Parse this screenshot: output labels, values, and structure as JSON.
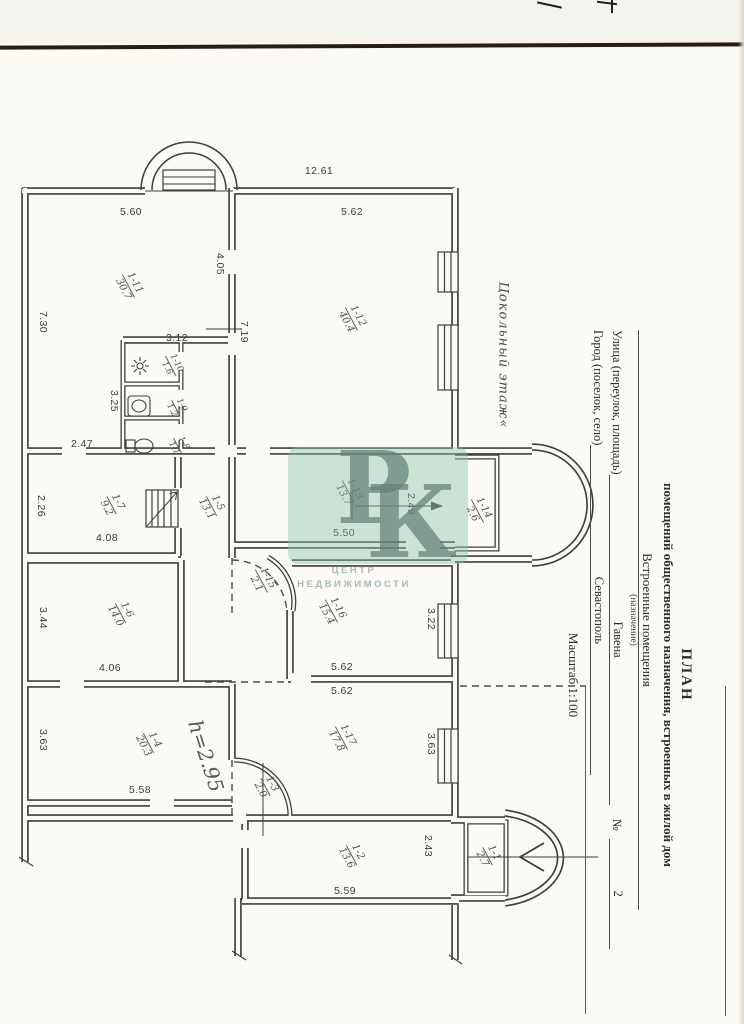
{
  "title_block": {
    "title": "ПЛАН",
    "subtitle": "помещений общественного назначения, встроенных в жилой дом",
    "designation_value": "Встроенные помещения",
    "designation_caption": "(назначение)",
    "street_label": "Улица (переулок, площадь)",
    "street_value": "Гавена",
    "house_number_label": "№",
    "house_number_value": "2",
    "city_label": "Город (поселок, село)",
    "city_value": "Севастополь",
    "scale_note": "Масштаб 1:100"
  },
  "notes": {
    "floor_note": "Цокольный этаж«",
    "height_note": "h=2.95"
  },
  "watermark": {
    "letter1": "Р",
    "letter2": "К",
    "caption_line1": "ЦЕНТР",
    "caption_line2": "НЕДВИЖИМОСТИ",
    "tile_color": "#86c4a8"
  },
  "rooms": {
    "r1_1": {
      "num": "1-1",
      "area": "2.7"
    },
    "r1_2": {
      "num": "1-2",
      "area": "13.6"
    },
    "r1_3": {
      "num": "1-3",
      "area": "2.0"
    },
    "r1_4": {
      "num": "1-4",
      "area": "20.3"
    },
    "r1_5": {
      "num": "1-5",
      "area": "13.1"
    },
    "r1_6": {
      "num": "1-6",
      "area": "14.0"
    },
    "r1_7": {
      "num": "1-7",
      "area": "9.2"
    },
    "r1_8": {
      "num": "1-8",
      "area": "1.1"
    },
    "r1_9": {
      "num": "1-9",
      "area": "1.2"
    },
    "r1_10": {
      "num": "1-10",
      "area": "1.6"
    },
    "r1_11": {
      "num": "1-11",
      "area": "30.7"
    },
    "r1_12": {
      "num": "1-12",
      "area": "40.4"
    },
    "r1_13": {
      "num": "1-13",
      "area": "13.7"
    },
    "r1_14": {
      "num": "1-14",
      "area": "2.6"
    },
    "r1_15": {
      "num": "1-15",
      "area": "2.1"
    },
    "r1_16": {
      "num": "1-16",
      "area": "15.4"
    },
    "r1_17": {
      "num": "1-17",
      "area": "17.8"
    }
  },
  "dims": {
    "overall_top": "12.61",
    "r11_top": "5.60",
    "r12_top": "5.62",
    "door_top": "4.05",
    "r11_left": "7.30",
    "r12_left": "7.19",
    "bath_top": "3.12",
    "bath_left": "3.25",
    "r11_bottom": "2.47",
    "r7_left": "2.26",
    "r7_bottom": "4.08",
    "bay_top": "2.49",
    "r13_bottom": "5.50",
    "r6_left": "3.44",
    "r6_bottom": "4.06",
    "r16_right": "3.22",
    "r16_bottom": "5.62",
    "r17_top": "5.62",
    "r4_left": "3.63",
    "r4_bottom": "5.58",
    "r17_right": "3.63",
    "r2_bottom": "5.59",
    "r2_right": "2.43"
  }
}
